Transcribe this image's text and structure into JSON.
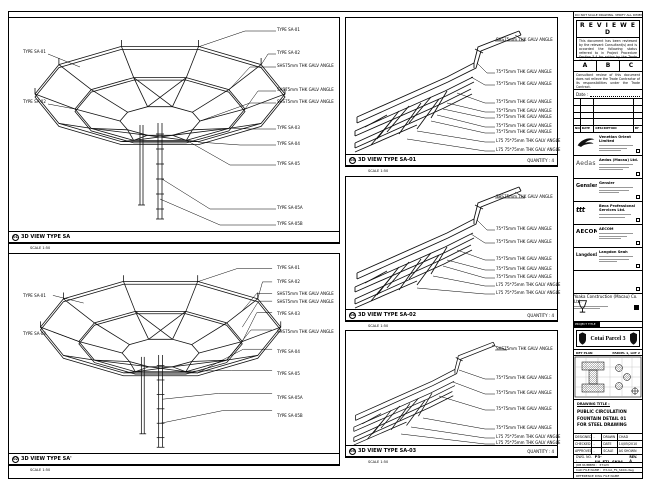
{
  "sheet": {
    "top_note": "DO NOT SCALE DRAWING. VERIFY ALL DIMENSIONS ON SITE BEFORE COMMENCING WORK."
  },
  "panels": {
    "tl": {
      "num": "01",
      "title": "3D VIEW TYPE SA",
      "scale": "SCALE 1:50",
      "right": [
        "TYPE SA-01",
        "TYPE SA-02",
        "SHS75mm THK GALV ANGLE",
        "SHS75mm THK GALV ANGLE",
        "SHS75mm THK GALV ANGLE",
        "TYPE SA-03",
        "TYPE SA-04",
        "TYPE SA-05",
        "TYPE SA-05A",
        "TYPE SA-05B"
      ],
      "left": [
        "TYPE SA-01",
        "TYPE SA-02"
      ]
    },
    "bl": {
      "num": "02",
      "title": "3D VIEW TYPE SA'",
      "scale": "SCALE 1:50",
      "right": [
        "TYPE SA-01",
        "TYPE SA-02",
        "SHS75mm THK GALV ANGLE",
        "SHS75mm THK GALV ANGLE",
        "TYPE SA-03",
        "SHS75mm THK GALV ANGLE",
        "TYPE SA-04",
        "TYPE SA-05",
        "TYPE SA-05A",
        "TYPE SA-05B"
      ],
      "left": [
        "TYPE SA-01",
        "TYPE SA-02"
      ]
    },
    "m1": {
      "num": "03",
      "title": "3D VIEW TYPE SA-01",
      "scale": "SCALE 1:50",
      "quantity": "QUANTITY : 4",
      "right": [
        "SHS75mm THK GALV ANGLE",
        "75*75mm THK GALV ANGLE",
        "75*75mm THK GALV ANGLE",
        "75*75mm THK GALV ANGLE",
        "75*75mm THK GALV ANGLE",
        "75*75mm THK GALV ANGLE",
        "75*75mm THK GALV ANGLE",
        "75*75mm THK GALV ANGLE",
        "L75 75*75mm THK GALV ANGLE",
        "L75 75*75mm THK GALV ANGLE"
      ]
    },
    "m2": {
      "num": "04",
      "title": "3D VIEW TYPE SA-02",
      "scale": "SCALE 1:50",
      "quantity": "QUANTITY : 4",
      "right": [
        "SHS75mm THK GALV ANGLE",
        "75*75mm THK GALV ANGLE",
        "75*75mm THK GALV ANGLE",
        "75*75mm THK GALV ANGLE",
        "75*75mm THK GALV ANGLE",
        "75*75mm THK GALV ANGLE",
        "L75 75*75mm THK GALV ANGLE",
        "L75 75*75mm THK GALV ANGLE"
      ]
    },
    "m3": {
      "num": "05",
      "title": "3D VIEW TYPE SA-03",
      "scale": "SCALE 1:50",
      "quantity": "QUANTITY : 4",
      "right": [
        "SHS75mm THK GALV ANGLE",
        "75*75mm THK GALV ANGLE",
        "75*75mm THK GALV ANGLE",
        "75*75mm THK GALV ANGLE",
        "75*75mm THK GALV ANGLE",
        "L75 75*75mm THK GALV ANGLE",
        "L75 75*75mm THK GALV ANGLE"
      ]
    }
  },
  "titleblock": {
    "reviewed_title": "R E V I E W E D",
    "reviewed_body": "This document has been reviewed by the relevant Consultant(s) and is accorded the following status referred to in Project Procedure Section 5.4 for action by the Trade Contractor.",
    "status_a": "A",
    "status_b": "B",
    "status_c": "C",
    "disclaimer": "Consultant review of this document does not relieve the Trade Contractor of its responsibilities under the Trade Contract.",
    "date_label": "Date :",
    "rev_header": {
      "no": "NO.",
      "date": "DATE",
      "desc": "DESCRIPTION",
      "by": "BY"
    },
    "companies": [
      {
        "name": "Venetian Orient Limited"
      },
      {
        "logo": "Aedas",
        "name": "Aedas (Macau) Ltd."
      },
      {
        "logo": "Gensler",
        "name": "Gensler"
      },
      {
        "logo": "ttt",
        "name": "Beca Professional Services Ltd."
      },
      {
        "logo": "AECOM",
        "name": "AECOM"
      },
      {
        "logo": "LangdonSeah",
        "name": "Langdon Seah"
      }
    ],
    "contractor": {
      "name": "Yoaka Construction (Macau) Co. Ltd."
    },
    "project_tag": "PROJECT TITLE",
    "project_title": "Cotai Parcel 3",
    "keyplan": {
      "label": "KEY PLAN",
      "right": "PARCEL 1, LOT 2"
    },
    "drawing_title_label": "DRAWING TITLE :",
    "drawing_title_1": "PUBLIC CIRCULATION",
    "drawing_title_2": "FOUNTAIN DETAIL 01",
    "drawing_title_3": "FOR STEEL DRAWING",
    "credits": {
      "designed_label": "DESIGNED",
      "designed": "-",
      "drawn_label": "DRAWN",
      "drawn": "CHAD",
      "checked_label": "CHECKED",
      "checked": "-",
      "date_label": "DATE",
      "date": "14/05/2010",
      "approved_label": "APPROVED",
      "approved": "-",
      "scale_label": "SCALE",
      "scale": "AS SHOWN"
    },
    "dwg_no_label": "DWG. NO. :",
    "dwg_no": "P3-UA_FTL_SK04",
    "rev": "REV. A",
    "job_label": "JOB NUMBER :",
    "job": "37123",
    "cad_label": "CAD FILE NAME :",
    "cad": "P3-UA_FS_SK04.dwg",
    "ref_label": "REFERENCE DWG FILE NAME"
  }
}
